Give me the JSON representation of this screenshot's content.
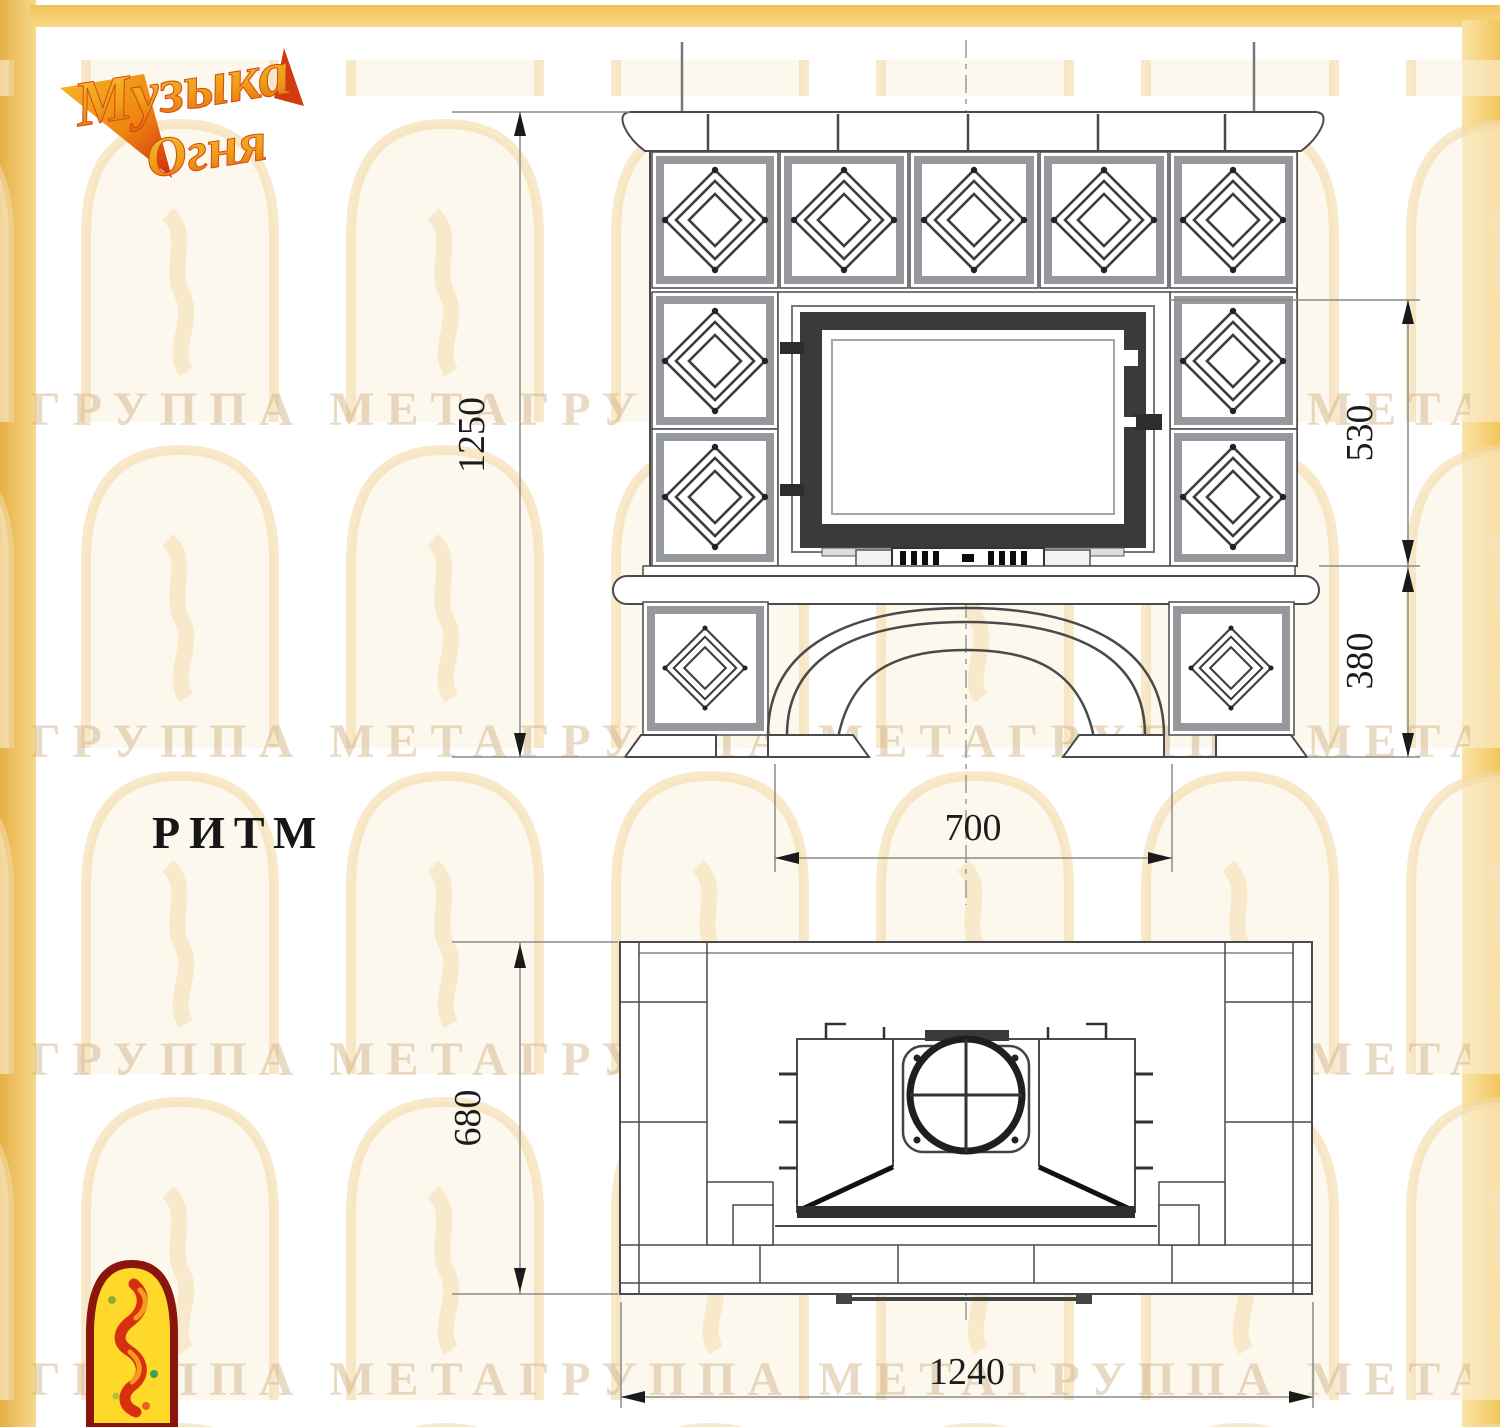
{
  "brand": {
    "logo_line1": "Музыка",
    "logo_line2": "Огня",
    "accent_yellow": "#f3c75f",
    "accent_orange": "#f59b1f",
    "accent_red": "#cf2a0e"
  },
  "watermark": {
    "text": "ГРУППА МЕТАГРУППА МЕТАГРУППА МЕТА"
  },
  "drawing": {
    "model_name": "РИТМ",
    "front_view": {
      "overall_height_mm": "1250",
      "firebox_zone_height_mm": "530",
      "base_height_mm": "380",
      "firebox_width_mm": "700"
    },
    "plan_view": {
      "depth_mm": "680",
      "width_mm": "1240"
    }
  }
}
